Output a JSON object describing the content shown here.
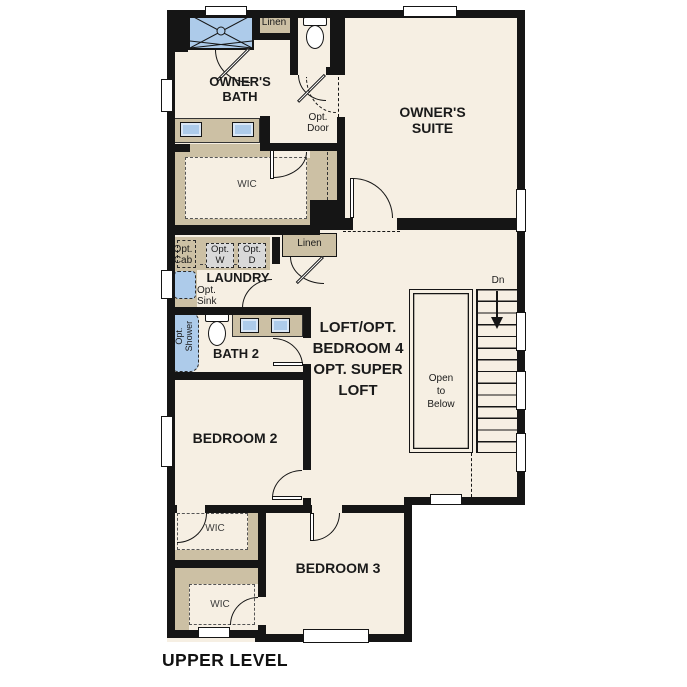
{
  "title": "UPPER LEVEL",
  "colors": {
    "wall": "#151515",
    "floor": "#f6efe3",
    "cabinet_tan": "#ccc0a4",
    "fixture_blue": "#adcbea",
    "appliance_gray": "#d9d9d9"
  },
  "rooms": {
    "owners_bath": "OWNER'S\nBATH",
    "owners_suite": "OWNER'S\nSUITE",
    "wic_owner": "WIC",
    "laundry": "LAUNDRY",
    "bath2": "BATH 2",
    "loft": "LOFT/OPT.\nBEDROOM 4\nOPT. SUPER\nLOFT",
    "bedroom2": "BEDROOM 2",
    "bedroom3": "BEDROOM 3",
    "wic_bedroom2": "WIC",
    "wic_bedroom3": "WIC"
  },
  "labels": {
    "linen_bath": "Linen",
    "linen_hall": "Linen",
    "opt_door": "Opt.\nDoor",
    "opt_cab": "Opt.\nCab",
    "opt_washer": "Opt.\nW",
    "opt_dryer": "Opt.\nD",
    "opt_sink": "Opt.\nSink",
    "opt_shower": "Opt.\nShower",
    "stairs_down": "Dn",
    "open_to_below": "Open\nto\nBelow"
  }
}
